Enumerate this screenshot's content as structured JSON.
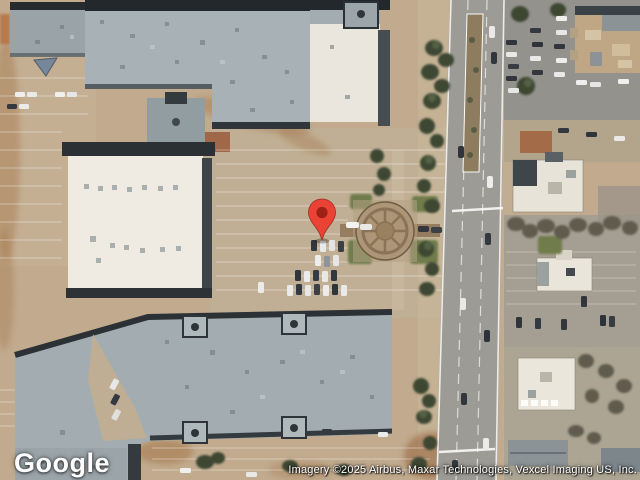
{
  "map": {
    "logo_text": "Google",
    "attribution": "Imagery ©2025 Airbus, Maxar Technologies, Vexcel Imaging US, Inc.",
    "view_type": "satellite",
    "pin": {
      "tip_x": 322,
      "tip_y": 240,
      "color": "#EA4335",
      "inner_color": "#8F1A0F"
    },
    "colors": {
      "ground": "#c1aa8e",
      "road": "#9d9b95",
      "roof_gray": "#a7b1b5",
      "roof_white": "#efebe2",
      "roof_edge_dark": "#23282c",
      "tree_green": "#3c4733",
      "dirt_orange": "#a97f55",
      "plaza_tan": "#ac9677"
    }
  }
}
